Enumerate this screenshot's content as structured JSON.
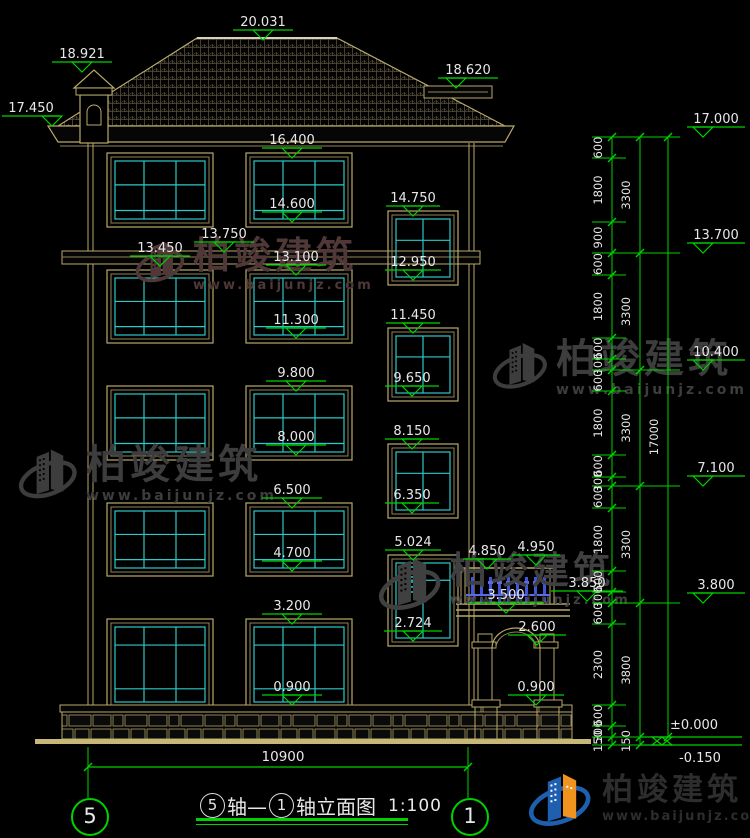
{
  "brand": {
    "name": "柏竣建筑",
    "url": "www.baijunjz.com"
  },
  "title_bar": {
    "axis_left": "5",
    "axis_right": "1",
    "seg1": "轴—",
    "seg2": "轴立面图",
    "scale": "1:100"
  },
  "bottom_dim": {
    "label": "10900"
  },
  "zero_markers": {
    "zero": "±0.000",
    "minus": "-0.150"
  },
  "colors": {
    "line_tan": "#b9a96a",
    "line_tan_dim": "#8f8256",
    "mullion_cyan": "#2cc9c9",
    "dim_green": "#00d200",
    "text_white": "#e8e8e8",
    "railing_blue": "#4156d8",
    "logo_blue": "#1f5fb0",
    "logo_orange": "#f0941f",
    "wm_gray": "#3d3d3d",
    "wm_maroon": "#503838"
  },
  "markers": [
    {
      "label": "20.031",
      "cx": 263,
      "fy": 40
    },
    {
      "label": "18.921",
      "cx": 82,
      "fy": 72
    },
    {
      "label": "17.450",
      "cx": 31,
      "fy": 126,
      "lw": 58,
      "tcx": 52
    },
    {
      "label": "18.620",
      "cx": 468,
      "fy": 88,
      "tcx": 456
    },
    {
      "label": "16.400",
      "cx": 292,
      "fy": 158
    },
    {
      "label": "14.600",
      "cx": 292,
      "fy": 222
    },
    {
      "label": "13.750",
      "cx": 224,
      "fy": 252
    },
    {
      "label": "13.450",
      "cx": 160,
      "fy": 266
    },
    {
      "label": "13.100",
      "cx": 296,
      "fy": 275
    },
    {
      "label": "11.300",
      "cx": 296,
      "fy": 338
    },
    {
      "label": "9.800",
      "cx": 296,
      "fy": 391
    },
    {
      "label": "8.000",
      "cx": 296,
      "fy": 455
    },
    {
      "label": "6.500",
      "cx": 292,
      "fy": 508
    },
    {
      "label": "4.700",
      "cx": 292,
      "fy": 571
    },
    {
      "label": "3.200",
      "cx": 292,
      "fy": 624
    },
    {
      "label": "0.900",
      "cx": 292,
      "fy": 705
    },
    {
      "label": "14.750",
      "cx": 413,
      "fy": 216,
      "lw": 54
    },
    {
      "label": "12.950",
      "cx": 413,
      "fy": 280,
      "lw": 56
    },
    {
      "label": "11.450",
      "cx": 413,
      "fy": 333,
      "lw": 54
    },
    {
      "label": "9.650",
      "cx": 412,
      "fy": 396,
      "lw": 54
    },
    {
      "label": "8.150",
      "cx": 412,
      "fy": 449,
      "lw": 54
    },
    {
      "label": "6.350",
      "cx": 412,
      "fy": 513,
      "lw": 54
    },
    {
      "label": "5.024",
      "cx": 413,
      "fy": 560,
      "lw": 56
    },
    {
      "label": "2.724",
      "cx": 413,
      "fy": 641,
      "lw": 58
    },
    {
      "label": "4.850",
      "cx": 487,
      "fy": 569,
      "lw": 48
    },
    {
      "label": "4.950",
      "cx": 536,
      "fy": 565,
      "lw": 48
    },
    {
      "label": "3.850",
      "cx": 587,
      "fy": 601,
      "lw": 72
    },
    {
      "label": "3.500",
      "cx": 506,
      "fy": 613,
      "lw": 76
    },
    {
      "label": "2.600",
      "cx": 537,
      "fy": 645,
      "lw": 58
    },
    {
      "label": "0.900",
      "cx": 536,
      "fy": 705,
      "lw": 56
    },
    {
      "label": "17.000",
      "cx": 716,
      "fy": 137,
      "lw": 58,
      "tcx": 703
    },
    {
      "label": "13.700",
      "cx": 716,
      "fy": 253,
      "lw": 58,
      "tcx": 703
    },
    {
      "label": "10.400",
      "cx": 716,
      "fy": 370,
      "lw": 58,
      "tcx": 703
    },
    {
      "label": "7.100",
      "cx": 716,
      "fy": 486,
      "lw": 58,
      "tcx": 703
    },
    {
      "label": "3.800",
      "cx": 716,
      "fy": 603,
      "lw": 58,
      "tcx": 703
    }
  ],
  "chains": {
    "inner": {
      "x": 612,
      "label_x": 602,
      "segments": [
        [
          "600",
          137,
          158
        ],
        [
          "1800",
          158,
          222
        ],
        [
          "900",
          222,
          253
        ],
        [
          "600",
          253,
          275
        ],
        [
          "1800",
          275,
          338
        ],
        [
          "600",
          338,
          359
        ],
        [
          "300",
          359,
          370
        ],
        [
          "600",
          370,
          391
        ],
        [
          "1800",
          391,
          455
        ],
        [
          "600",
          455,
          477
        ],
        [
          "300",
          477,
          486
        ],
        [
          "600",
          486,
          508
        ],
        [
          "1800",
          508,
          571
        ],
        [
          "600",
          571,
          592
        ],
        [
          "300",
          592,
          603
        ],
        [
          "600",
          603,
          624
        ],
        [
          "2300",
          624,
          705
        ],
        [
          "600",
          705,
          726
        ],
        [
          "300",
          726,
          737
        ],
        [
          "150",
          737,
          745
        ]
      ]
    },
    "middle": {
      "x": 640,
      "label_x": 630,
      "segments": [
        [
          "3300",
          137,
          253
        ],
        [
          "3300",
          253,
          370
        ],
        [
          "3300",
          370,
          486
        ],
        [
          "3300",
          486,
          603
        ],
        [
          "3800",
          603,
          737
        ],
        [
          "150",
          737,
          745
        ]
      ]
    },
    "outer": {
      "x": 668,
      "label_x": 658,
      "segments": [
        [
          "17000",
          137,
          737
        ]
      ]
    }
  },
  "geometry": {
    "roof_pts": "58,126 197,38 337,38 505,126",
    "fascia_pts": "48,126 514,126 505,142 58,142",
    "ledge": {
      "x": 424,
      "y": 86,
      "w": 68,
      "h": 12
    },
    "chimney": {
      "bx": 80,
      "by": 95,
      "bw": 28,
      "bh": 48,
      "pyr": "74,88 94,70 114,88",
      "cap": [
        76,
        88,
        36,
        7
      ]
    },
    "walls": {
      "top": 143,
      "bot": 705,
      "left": [
        88,
        93
      ],
      "right": [
        469,
        474
      ]
    },
    "band": {
      "x": 62,
      "y": 251,
      "w": 418,
      "h": 13,
      "mid": 257
    },
    "base_cap": {
      "x": 60,
      "y": 705,
      "w": 512,
      "h": 7
    },
    "stone": {
      "x": 62,
      "y": 712,
      "w": 510,
      "h": 27
    },
    "ground": {
      "x": 35,
      "y": 739,
      "w": 556,
      "h": 5
    },
    "big_cols": [
      112,
      251
    ],
    "big_w": 96,
    "big_rows": [
      [
        158,
        64
      ],
      [
        275,
        63
      ],
      [
        391,
        64
      ],
      [
        508,
        63
      ],
      [
        624,
        81
      ]
    ],
    "small_x": 393,
    "small_w": 60,
    "small_rows": [
      [
        216,
        64
      ],
      [
        333,
        63
      ],
      [
        449,
        64
      ]
    ],
    "door": {
      "y": 560,
      "h": 81
    },
    "porch": {
      "slab_lines": [
        604,
        610,
        616
      ],
      "slab_x": 456,
      "slab_w": 114,
      "piers": [
        [
          478,
          14
        ],
        [
          540,
          14
        ]
      ],
      "pier_top": 634,
      "pier_bot": 700,
      "caps": [
        [
          472,
          28
        ],
        [
          534,
          28
        ]
      ],
      "cap_y": 700,
      "cap_h": 7,
      "peds": [
        [
          475,
          22
        ],
        [
          537,
          22
        ]
      ],
      "ped_y": 707,
      "ped_h": 32,
      "arch_l": 492,
      "arch_r": 540,
      "arch_spring": 648,
      "arch_ry": 20,
      "rail_x": 466,
      "rail_w": 84,
      "rail_top": 568,
      "rail_bot": 604,
      "posts": [
        461,
        550
      ]
    },
    "dim_line": {
      "y": 767,
      "x1": 88,
      "x2": 468
    },
    "axis_x": [
      88,
      468
    ]
  }
}
